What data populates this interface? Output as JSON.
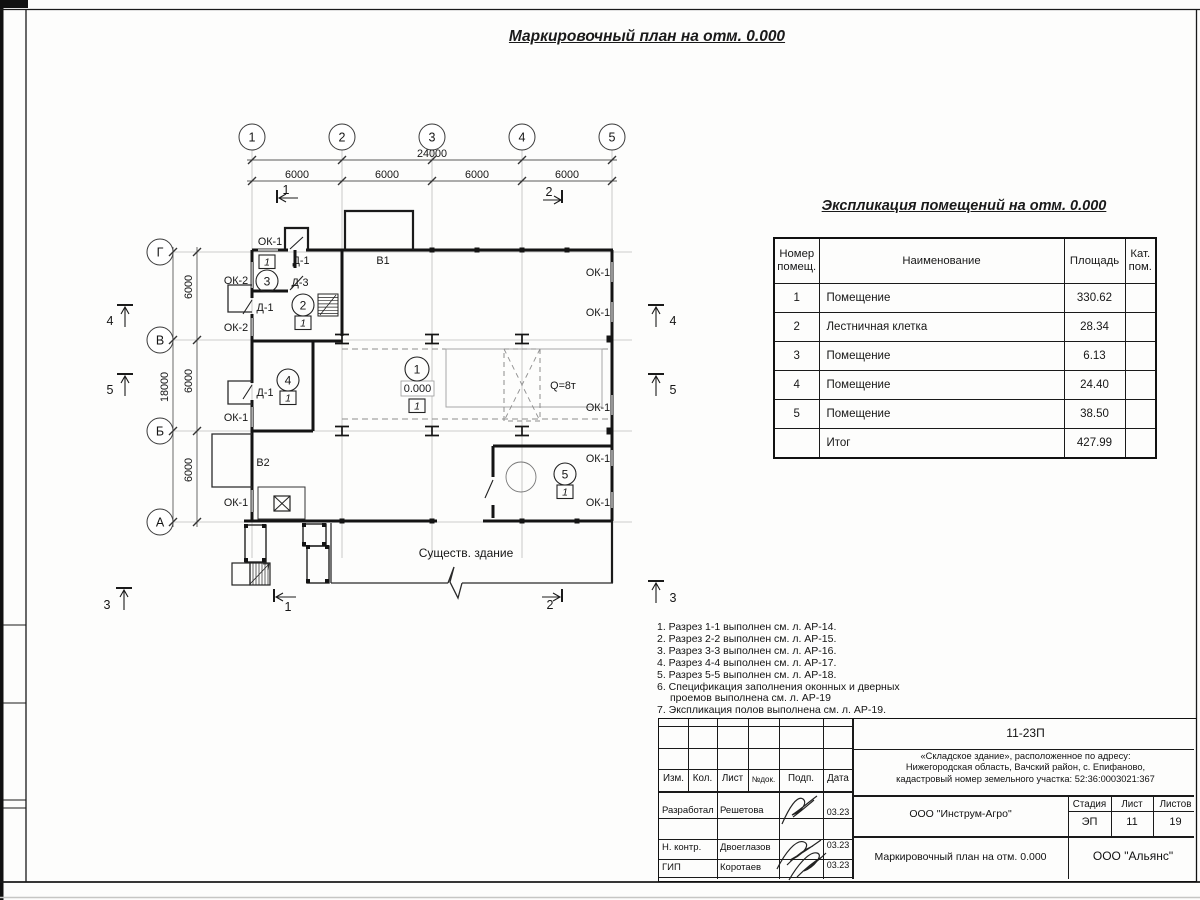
{
  "sheet_title": "Маркировочный план на отм. 0.000",
  "plan": {
    "grid": {
      "top_axes": [
        {
          "label": "1",
          "x": 252
        },
        {
          "label": "2",
          "x": 342
        },
        {
          "label": "3",
          "x": 432
        },
        {
          "label": "4",
          "x": 522
        },
        {
          "label": "5",
          "x": 612
        }
      ],
      "left_axes": [
        {
          "label": "Г",
          "y": 252
        },
        {
          "label": "В",
          "y": 340
        },
        {
          "label": "Б",
          "y": 431
        },
        {
          "label": "А",
          "y": 522
        }
      ]
    },
    "dims": [
      {
        "t": "24000",
        "x": 432,
        "y": 157
      },
      {
        "t": "6000",
        "x": 297,
        "y": 178
      },
      {
        "t": "6000",
        "x": 387,
        "y": 178
      },
      {
        "t": "6000",
        "x": 477,
        "y": 178
      },
      {
        "t": "6000",
        "x": 567,
        "y": 178
      },
      {
        "t": "18000",
        "x": 168,
        "y": 387,
        "rot": -90
      },
      {
        "t": "6000",
        "x": 192,
        "y": 287,
        "rot": -90
      },
      {
        "t": "6000",
        "x": 192,
        "y": 381,
        "rot": -90
      },
      {
        "t": "6000",
        "x": 192,
        "y": 470,
        "rot": -90
      }
    ],
    "labels": [
      {
        "t": "ОК-1",
        "x": 270,
        "y": 245
      },
      {
        "t": "Д-1",
        "x": 301,
        "y": 264
      },
      {
        "t": "Д-3",
        "x": 300,
        "y": 286
      },
      {
        "t": "ОК-2",
        "x": 236,
        "y": 284
      },
      {
        "t": "Д-1",
        "x": 265,
        "y": 311
      },
      {
        "t": "ОК-2",
        "x": 236,
        "y": 331
      },
      {
        "t": "Д-1",
        "x": 265,
        "y": 396
      },
      {
        "t": "ОК-1",
        "x": 236,
        "y": 421
      },
      {
        "t": "В2",
        "x": 263,
        "y": 466
      },
      {
        "t": "ОК-1",
        "x": 236,
        "y": 506
      },
      {
        "t": "В1",
        "x": 383,
        "y": 264
      },
      {
        "t": "ОК-1",
        "x": 598,
        "y": 276
      },
      {
        "t": "ОК-1",
        "x": 598,
        "y": 316
      },
      {
        "t": "ОК-1",
        "x": 598,
        "y": 411
      },
      {
        "t": "ОК-1",
        "x": 598,
        "y": 462
      },
      {
        "t": "ОК-1",
        "x": 598,
        "y": 506
      },
      {
        "t": "Q=8т",
        "x": 563,
        "y": 389
      },
      {
        "t": "0.000",
        "x": 417.5,
        "y": 392,
        "cls": "lvl"
      },
      {
        "t": "Существ. здание",
        "x": 466,
        "y": 557,
        "cls": "big"
      },
      {
        "t": "1",
        "x": 286,
        "y": 194,
        "cls": "sec"
      },
      {
        "t": "2",
        "x": 549,
        "y": 196,
        "cls": "sec"
      },
      {
        "t": "1",
        "x": 288,
        "y": 611,
        "cls": "sec"
      },
      {
        "t": "2",
        "x": 550,
        "y": 609,
        "cls": "sec"
      },
      {
        "t": "4",
        "x": 110,
        "y": 325,
        "cls": "sec"
      },
      {
        "t": "5",
        "x": 110,
        "y": 394,
        "cls": "sec"
      },
      {
        "t": "3",
        "x": 107,
        "y": 609,
        "cls": "sec"
      },
      {
        "t": "4",
        "x": 673,
        "y": 325,
        "cls": "sec"
      },
      {
        "t": "5",
        "x": 673,
        "y": 394,
        "cls": "sec"
      },
      {
        "t": "3",
        "x": 673,
        "y": 602,
        "cls": "sec"
      }
    ],
    "rooms": [
      {
        "num": "1",
        "cx": 417,
        "cy": 369,
        "r": 12,
        "box": [
          409,
          399
        ],
        "fin": "1"
      },
      {
        "num": "2",
        "cx": 303,
        "cy": 305,
        "r": 11,
        "box": [
          295,
          316
        ],
        "fin": "1"
      },
      {
        "num": "3",
        "cx": 267,
        "cy": 281,
        "r": 11,
        "box": [
          259,
          255
        ],
        "fin": "1"
      },
      {
        "num": "4",
        "cx": 288,
        "cy": 380,
        "r": 11,
        "box": [
          280,
          391
        ],
        "fin": "1"
      },
      {
        "num": "5",
        "cx": 565,
        "cy": 474,
        "r": 11,
        "box": [
          557,
          485
        ],
        "fin": "1"
      }
    ]
  },
  "explication": {
    "title": "Экспликация помещений на отм. 0.000",
    "headers": [
      "Номер\nпомещ.",
      "Наименование",
      "Площадь",
      "Кат.\nпом."
    ],
    "rows": [
      [
        "1",
        "Помещение",
        "330.62",
        ""
      ],
      [
        "2",
        "Лестничная клетка",
        "28.34",
        ""
      ],
      [
        "3",
        "Помещение",
        "6.13",
        ""
      ],
      [
        "4",
        "Помещение",
        "24.40",
        ""
      ],
      [
        "5",
        "Помещение",
        "38.50",
        ""
      ],
      [
        "",
        "Итог",
        "427.99",
        ""
      ]
    ]
  },
  "notes": [
    {
      "t": "1. Разрез 1-1 выполнен см. л. АР-14."
    },
    {
      "t": "2. Разрез 2-2 выполнен см. л. АР-15."
    },
    {
      "t": "3. Разрез 3-3 выполнен см. л. АР-16."
    },
    {
      "t": "4. Разрез 4-4 выполнен см. л. АР-17."
    },
    {
      "t": "5. Разрез 5-5 выполнен см. л. АР-18."
    },
    {
      "t": "6. Спецификация заполнения оконных и дверных"
    },
    {
      "t": "проемов выполнена см. л. АР-19",
      "indent": true
    },
    {
      "t": "7. Экспликация полов выполнена см. л. АР-19."
    }
  ],
  "title_block": {
    "code": "11-23П",
    "object_lines": [
      "«Складское здание», расположенное по адресу:",
      "Нижегородская область, Вачский район, с. Епифаново,",
      "кадастровый номер земельного участка: 52:36:0003021:367"
    ],
    "org": "ООО \"Инструм-Агро\"",
    "doc_title": "Маркировочный план на отм. 0.000",
    "company": "ООО \"Альянс\"",
    "stage_label": "Стадия",
    "sheet_label": "Лист",
    "sheets_label": "Листов",
    "stage": "ЭП",
    "sheet": "11",
    "sheets": "19",
    "header_cols": [
      "Изм.",
      "Кол.",
      "Лист",
      "№док.",
      "Подп.",
      "Дата"
    ],
    "rows": [
      {
        "role": "Разработал",
        "name": "Решетова",
        "date": "03.23"
      },
      {
        "role": "Н. контр.",
        "name": "Двоеглазов",
        "date": "03.23"
      },
      {
        "role": "ГИП",
        "name": "Коротаев",
        "date": "03.23"
      }
    ]
  }
}
